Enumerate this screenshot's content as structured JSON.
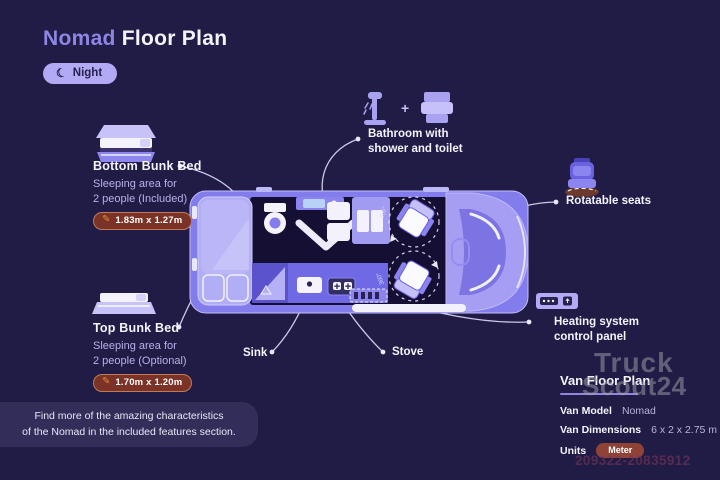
{
  "colors": {
    "background": "#211c46",
    "accent_purple": "#8e86e2",
    "van_body": "#837cec",
    "interior_dark": "#150f33",
    "badge_lavender": "#b2aaf4",
    "dim_badge_maroon": "#7a3326",
    "unit_pill_maroon": "#8f4336",
    "panel_note_bg": "#322d59",
    "text_white": "#f4f3fb",
    "text_light_purple": "#b7b1e8"
  },
  "header": {
    "title_accent": "Nomad",
    "title_rest": "Floor Plan",
    "mode_badge": "Night",
    "moon_icon": "☾"
  },
  "features": {
    "bottom_bunk": {
      "title": "Bottom Bunk Bed",
      "subtitle_line1": "Sleeping area for",
      "subtitle_line2": "2 people (Included)",
      "dimensions": "1.83m x 1.27m",
      "pencil_icon": "✎"
    },
    "top_bunk": {
      "title": "Top Bunk Bed",
      "subtitle_line1": "Sleeping area for",
      "subtitle_line2": "2 people (Optional)",
      "dimensions": "1.70m x 1.20m",
      "pencil_icon": "✎"
    },
    "bathroom": {
      "title_line1": "Bathroom with",
      "title_line2": "shower and toilet",
      "icons_plus": "+"
    },
    "rotatable_seats": {
      "title": "Rotatable seats"
    },
    "heating": {
      "title_line1": "Heating system",
      "title_line2": "control panel"
    },
    "sink": {
      "title": "Sink"
    },
    "stove": {
      "title": "Stove"
    }
  },
  "floor_plan": {
    "seat_rotation": "360°"
  },
  "info_panel": {
    "heading": "Van Floor Plan",
    "rows": [
      {
        "label": "Van Model",
        "value": "Nomad"
      },
      {
        "label": "Van Dimensions",
        "value": "6 x 2 x 2.75 m"
      },
      {
        "label": "Units",
        "value": "Meter"
      }
    ]
  },
  "footer_note": {
    "line1": "Find more of the amazing characteristics",
    "line2": "of the Nomad in the included features section."
  },
  "watermark": {
    "line1": "Truck",
    "line2": "Scout24",
    "id_number": "209322-20835912"
  }
}
